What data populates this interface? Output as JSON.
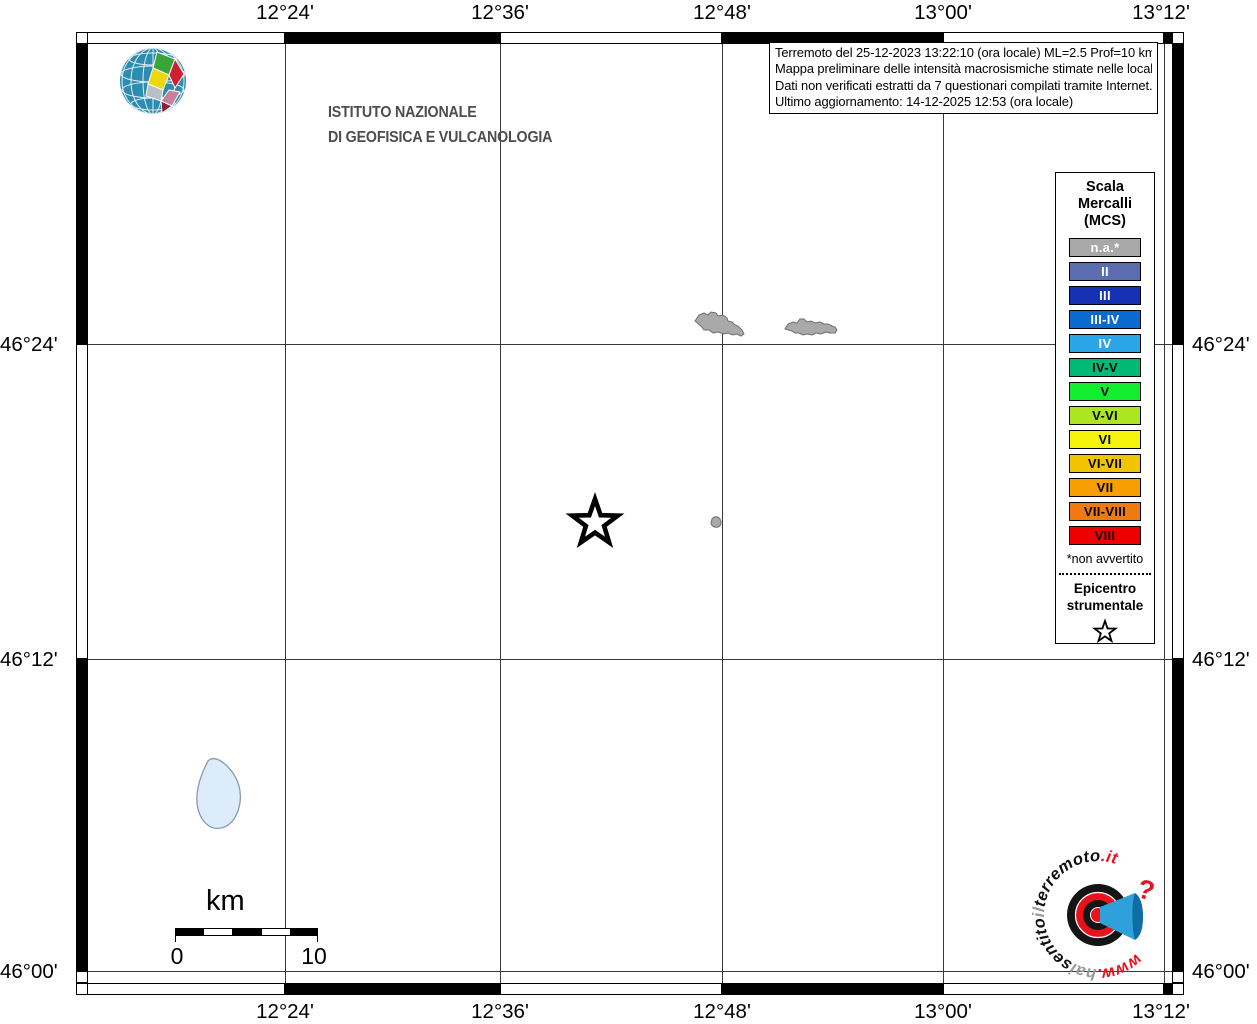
{
  "axis": {
    "top_labels": [
      "12°24'",
      "12°36'",
      "12°48'",
      "13°00'",
      "13°12'"
    ],
    "bottom_labels": [
      "12°24'",
      "12°36'",
      "12°48'",
      "13°00'",
      "13°12'"
    ],
    "left_labels": [
      "46°24'",
      "46°12'",
      "46°00'"
    ],
    "right_labels": [
      "46°24'",
      "46°12'",
      "46°00'"
    ]
  },
  "branding": {
    "institute_line1": "ISTITUTO NAZIONALE",
    "institute_line2": "DI GEOFISICA E VULCANOLOGIA"
  },
  "info_box": {
    "line1": "Terremoto del 25-12-2023 13:22:10 (ora locale) ML=2.5 Prof=10 km",
    "line2": "Mappa preliminare delle intensità macrosismiche stimate nelle località",
    "line3": "Dati non verificati estratti da 7 questionari compilati tramite Internet.",
    "line4": "Ultimo aggiornamento: 14-12-2025 12:53 (ora locale)"
  },
  "legend": {
    "title_line1": "Scala",
    "title_line2": "Mercalli",
    "title_line3": "(MCS)",
    "items": [
      {
        "label": "n.a.*",
        "color": "#a8a8a8",
        "text_color": "#ffffff"
      },
      {
        "label": "II",
        "color": "#5c6cb1",
        "text_color": "#ffffff"
      },
      {
        "label": "III",
        "color": "#1632b4",
        "text_color": "#ffffff"
      },
      {
        "label": "III-IV",
        "color": "#0a6ad2",
        "text_color": "#ffffff"
      },
      {
        "label": "IV",
        "color": "#2ba4e8",
        "text_color": "#ffffff"
      },
      {
        "label": "IV-V",
        "color": "#00b976",
        "text_color": "#000000"
      },
      {
        "label": "V",
        "color": "#12ee2e",
        "text_color": "#000000"
      },
      {
        "label": "V-VI",
        "color": "#ace620",
        "text_color": "#000000"
      },
      {
        "label": "VI",
        "color": "#f5f50c",
        "text_color": "#000000"
      },
      {
        "label": "VI-VII",
        "color": "#f2c300",
        "text_color": "#000000"
      },
      {
        "label": "VII",
        "color": "#f79f00",
        "text_color": "#000000"
      },
      {
        "label": "VII-VIII",
        "color": "#ef7a10",
        "text_color": "#000000"
      },
      {
        "label": "VIII",
        "color": "#ee0000",
        "text_color": "#000000"
      }
    ],
    "footnote": "*non avvertito",
    "epicenter_line1": "Epicentro",
    "epicenter_line2": "strumentale"
  },
  "scale_bar": {
    "unit": "km",
    "start_label": "0",
    "end_label": "10"
  },
  "watermark": {
    "part_www": "www.",
    "part_hai": "hai",
    "part_sentito": "sentito",
    "part_il": "il",
    "part_terremoto": "terremoto",
    "part_it": ".it",
    "question_mark": "?",
    "color_red": "#e8111c",
    "color_gray": "#9a9a9a",
    "color_black": "#111111"
  }
}
